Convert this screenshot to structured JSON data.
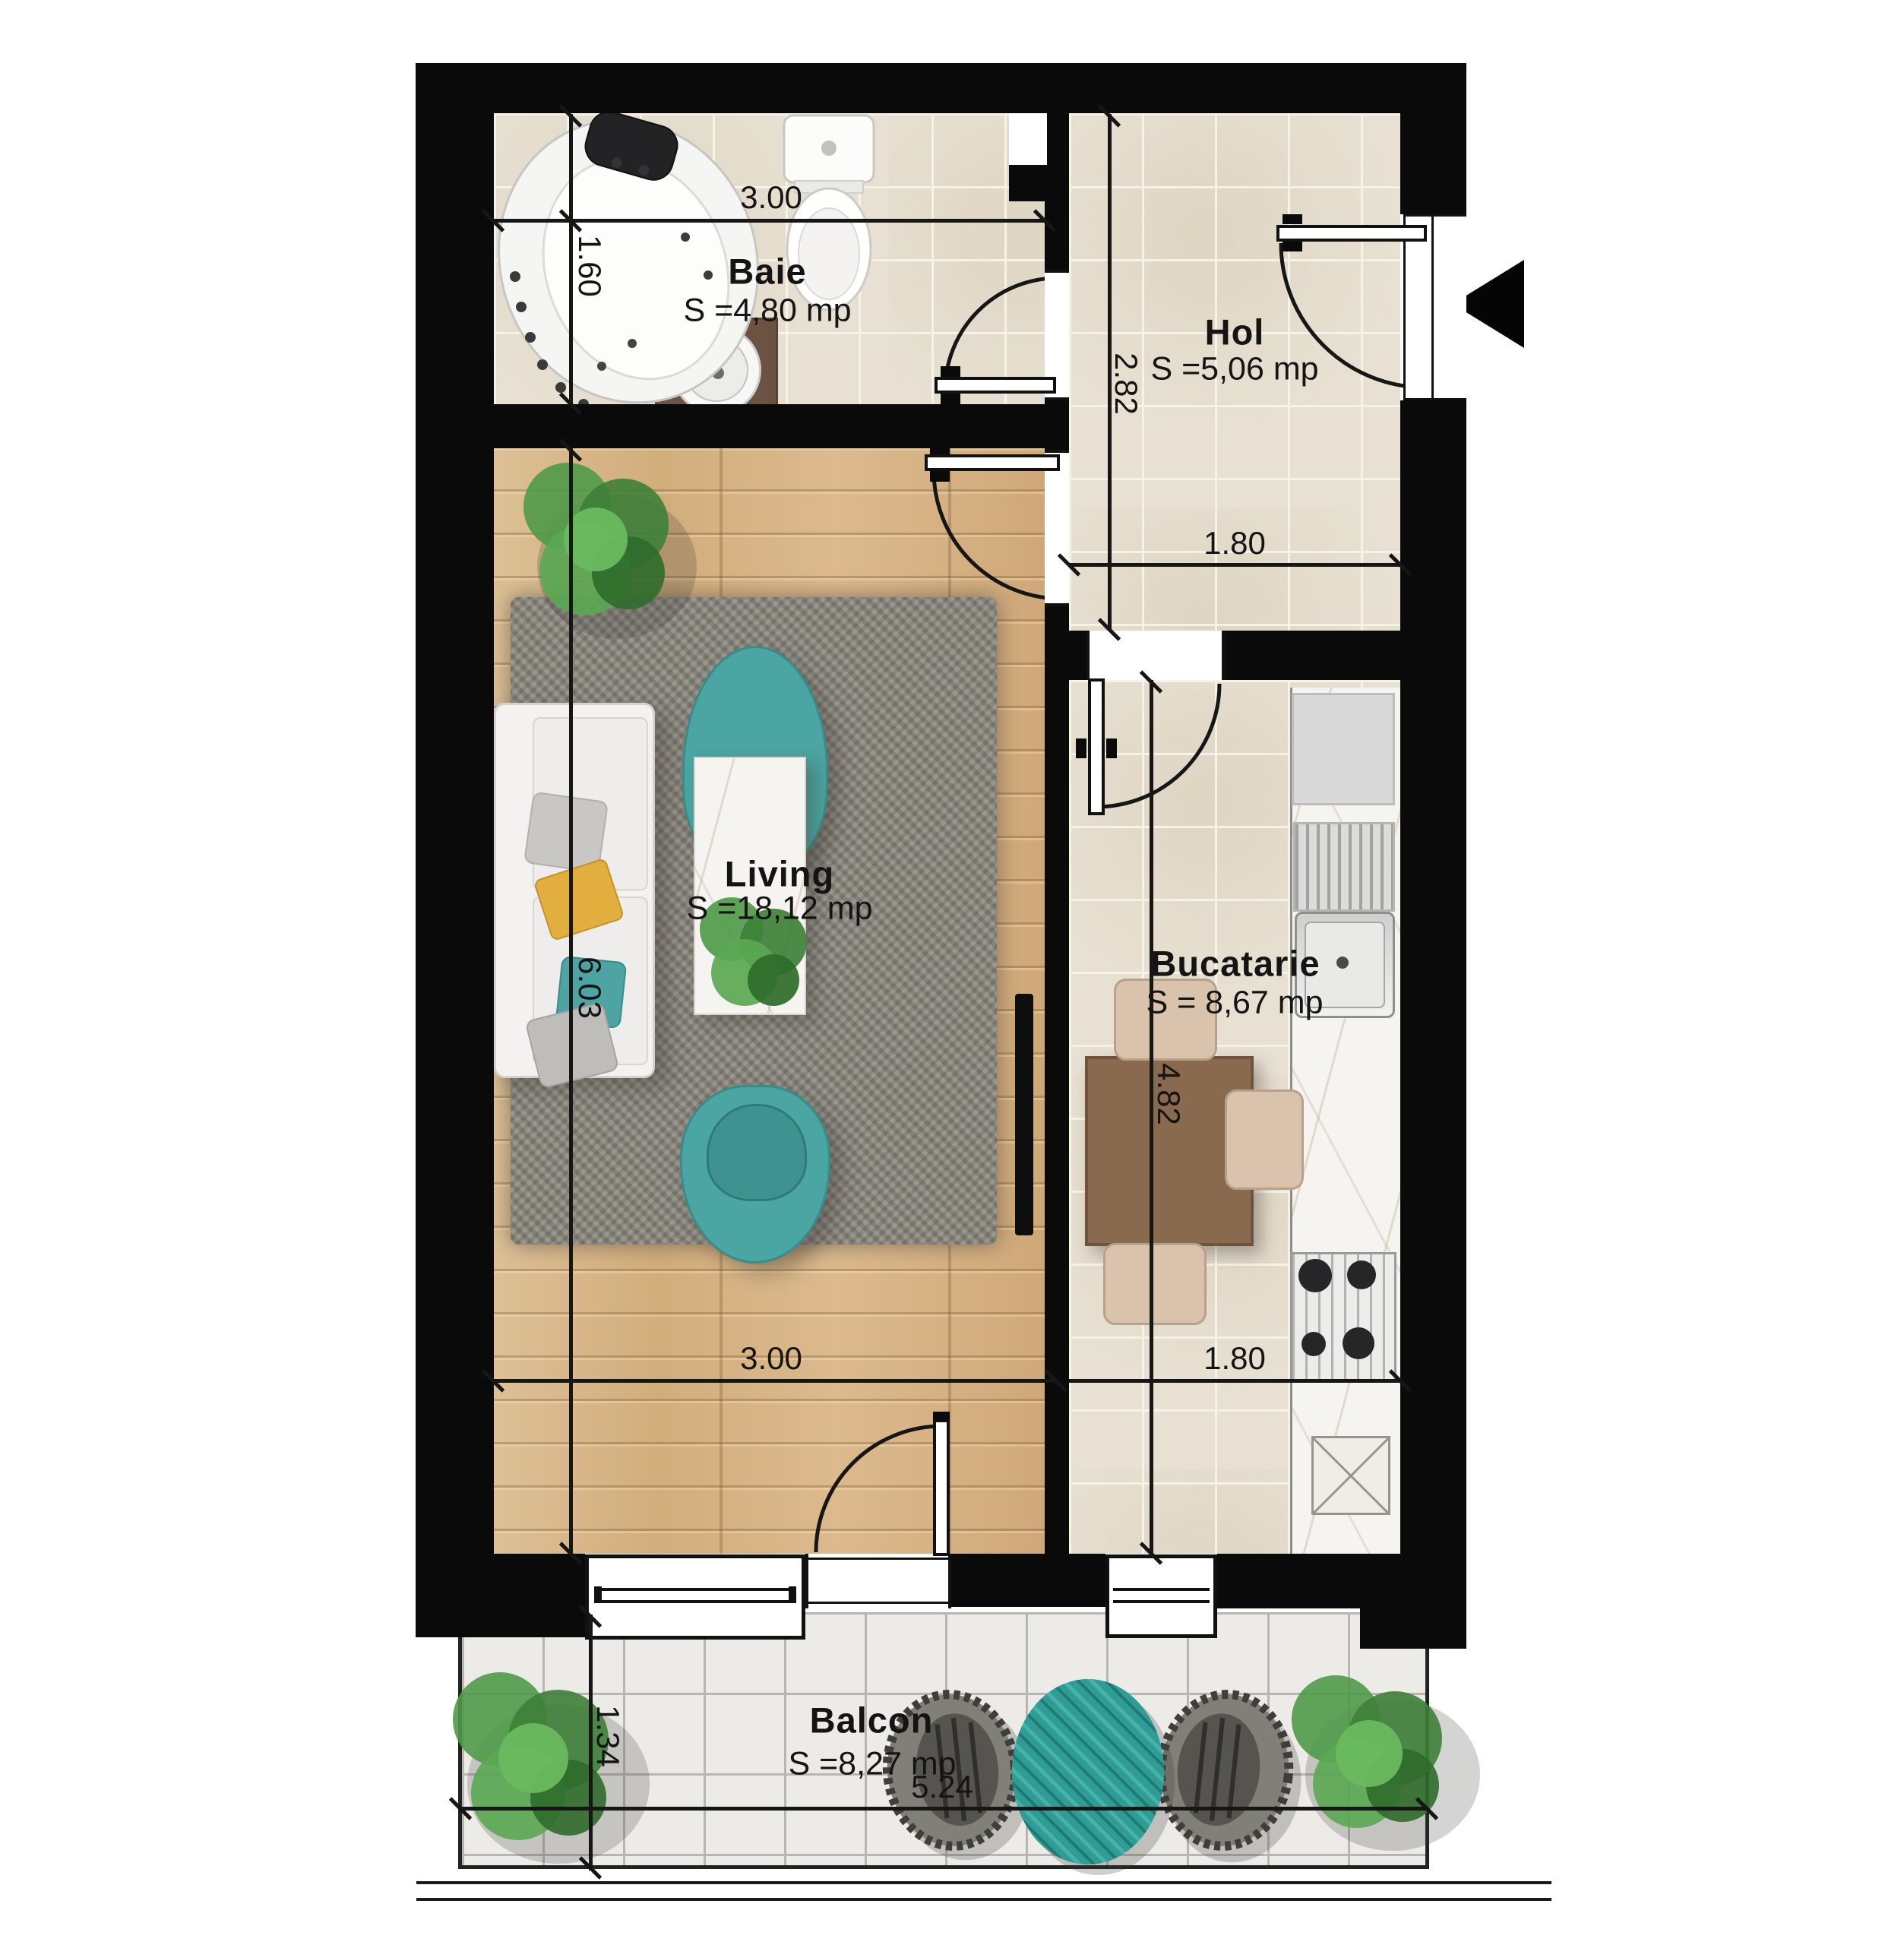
{
  "plan": {
    "rooms": {
      "baie": {
        "name": "Baie",
        "area": "S =4,80 mp"
      },
      "hol": {
        "name": "Hol",
        "area": "S =5,06 mp"
      },
      "living": {
        "name": "Living",
        "area": "S =18,12 mp"
      },
      "bucatarie": {
        "name": "Bucatarie",
        "area": "S = 8,67 mp"
      },
      "balcon": {
        "name": "Balcon",
        "area": "S =8,27 mp"
      }
    },
    "dimensions": {
      "baie_width": "3.00",
      "baie_height": "1.60",
      "hol_height": "2.82",
      "hol_width": "1.80",
      "living_height": "6.03",
      "living_width": "3.00",
      "bucatarie_height": "4.82",
      "bucatarie_width": "1.80",
      "balcon_height": "1.34",
      "balcon_width": "5.24"
    },
    "icons": {
      "entrance_arrow": "left-pointing-triangle"
    },
    "colors": {
      "wall": "#0a0a0a",
      "tile_beige": "#e8e1d3",
      "wood": "#d8b88d",
      "balcony_tile": "#edebe8",
      "rug_grey": "#8c8980",
      "accent_teal": "#47a3a1",
      "marble": "#f6f4f0",
      "cabinet_brown": "#6b5242",
      "table_wood": "#8a6a4e",
      "chair_beige": "#d9c3ac"
    }
  }
}
